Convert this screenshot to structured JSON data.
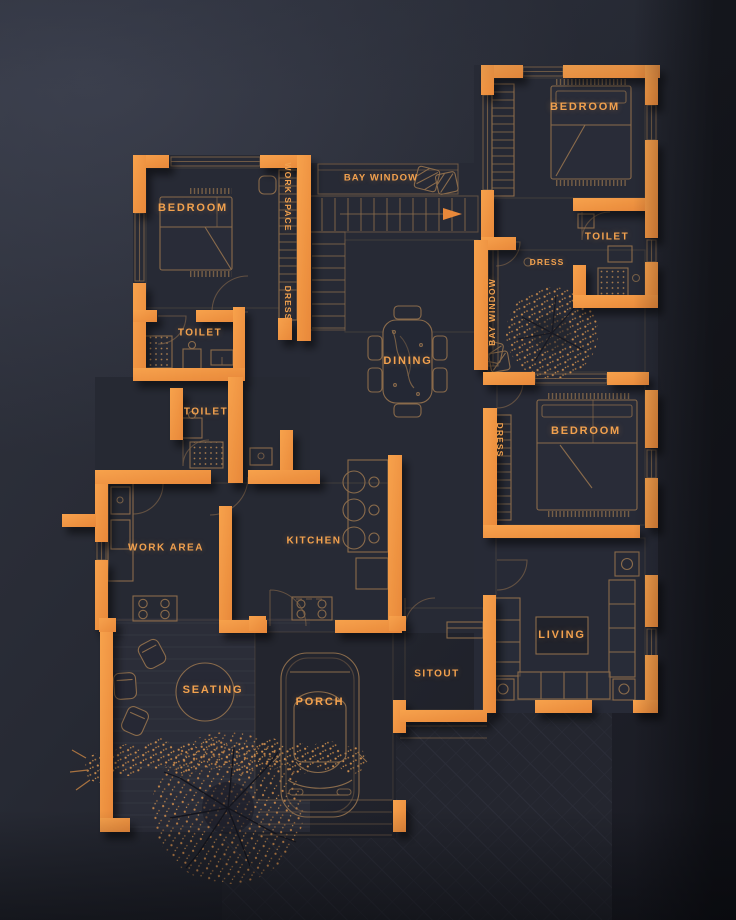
{
  "title": "Residential Floor Plan",
  "colors": {
    "background": "#262934",
    "wall_accent": "#F2953F",
    "label_text": "#F2A14E",
    "furniture_line": "#8a6b4b",
    "foliage": "#cf8f4e"
  },
  "rooms": {
    "bedroom_nw": "BEDROOM",
    "work_space": "WORK SPACE",
    "dress_nw": "DRESS",
    "bay_window_top": "BAY WINDOW",
    "bedroom_ne": "BEDROOM",
    "toilet_ne": "TOILET",
    "dress_ne": "DRESS",
    "bay_window_right": "BAY WINDOW",
    "toilet_a": "TOILET",
    "toilet_b": "TOILET",
    "bedroom_e": "BEDROOM",
    "dress_e": "DRESS",
    "dining": "DINING",
    "work_area": "WORK AREA",
    "kitchen": "KITCHEN",
    "seating": "SEATING",
    "porch": "PORCH",
    "sitout": "SITOUT",
    "living": "LIVING"
  }
}
